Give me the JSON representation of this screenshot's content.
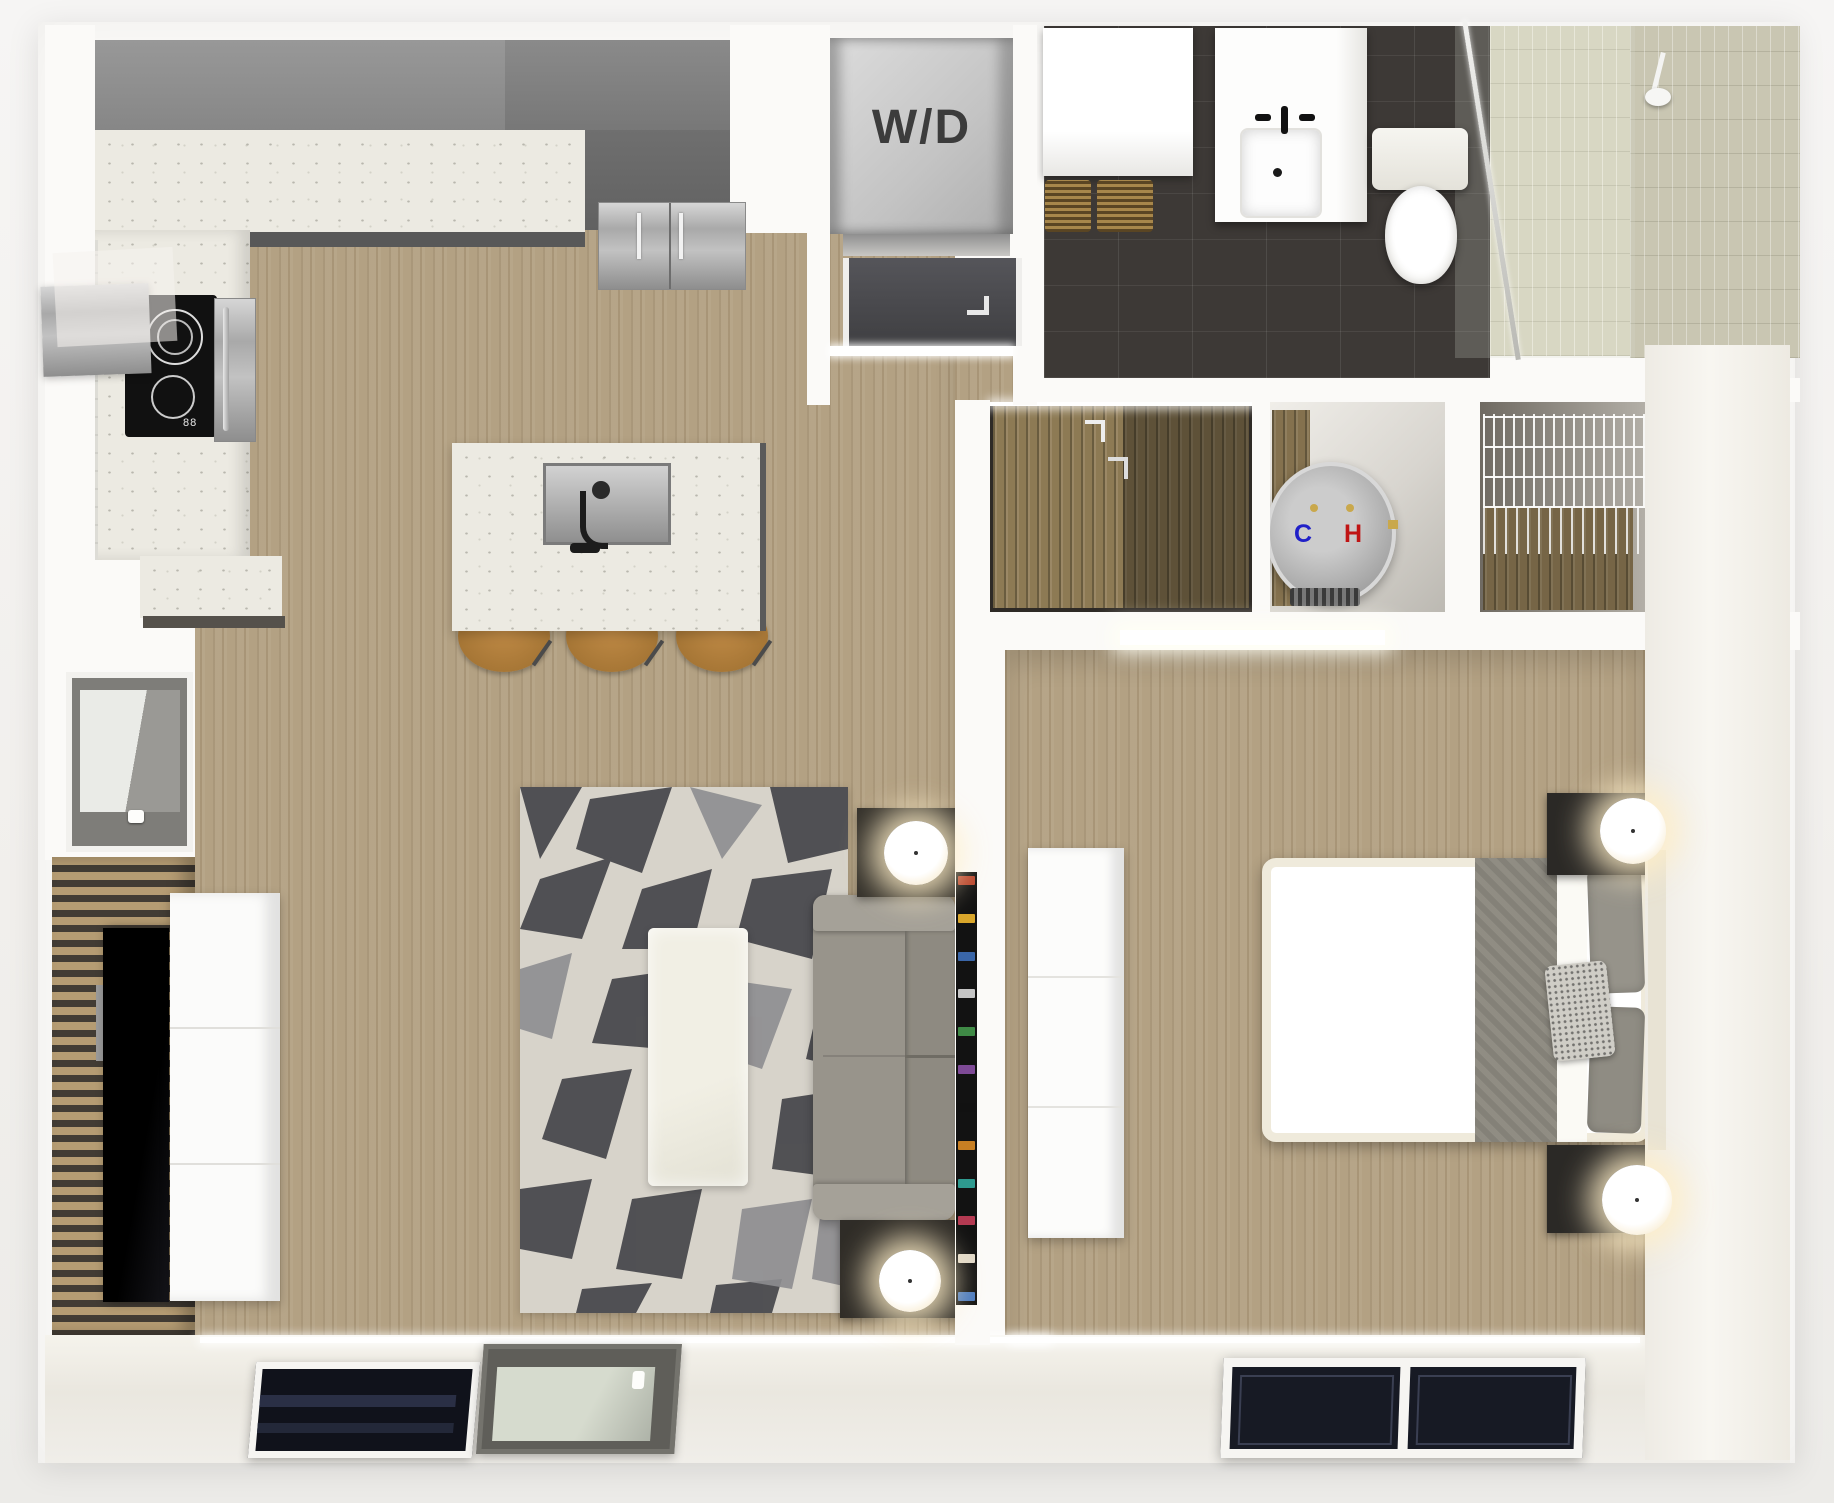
{
  "scene": {
    "type": "apartment-floor-plan-3d-render",
    "labels": {
      "washer_dryer": "W/D",
      "cold_water": "C",
      "hot_water": "H"
    },
    "palette": {
      "background": "#f4f3f1",
      "wall": "#fbfaf8",
      "wood_floor": "#b3a183",
      "cabinet_gray": "#8d8d8d",
      "counter_speckled": "#eceae2",
      "bath_tile_dark": "#3d3936",
      "shower_tile": "#c9c6b2",
      "rug_base": "#d7d3ca",
      "rug_dark": "#45454a",
      "sofa_gray": "#98948b",
      "stool_leather": "#b5813f",
      "bed_blanket_gray": "#8b887e",
      "lamp_glow": "#ffeecb",
      "cold_label_color": "#2020c8",
      "hot_label_color": "#c01414"
    },
    "rooms": [
      {
        "name": "kitchen",
        "items": [
          "upper-cabinets",
          "counter",
          "cooktop",
          "range-hood",
          "wall-oven",
          "refrigerator",
          "island-with-sink",
          "bar-stools"
        ]
      },
      {
        "name": "laundry-closet",
        "items": [
          "stacked-washer-dryer"
        ]
      },
      {
        "name": "entry",
        "items": [
          "entry-door",
          "coat-closet"
        ]
      },
      {
        "name": "bathroom",
        "items": [
          "shelf-with-baskets",
          "vanity-sink",
          "toilet",
          "walk-in-shower"
        ]
      },
      {
        "name": "utility-closet",
        "items": [
          "water-heater"
        ]
      },
      {
        "name": "linen-closet",
        "items": [
          "wire-shelving"
        ]
      },
      {
        "name": "living-room",
        "items": [
          "geometric-rug",
          "coffee-table",
          "sofa",
          "side-tables-with-lamps",
          "bookcase",
          "tv",
          "media-console",
          "window"
        ]
      },
      {
        "name": "bedroom",
        "items": [
          "bed",
          "nightstands-with-lamps",
          "dresser",
          "window"
        ]
      }
    ]
  }
}
